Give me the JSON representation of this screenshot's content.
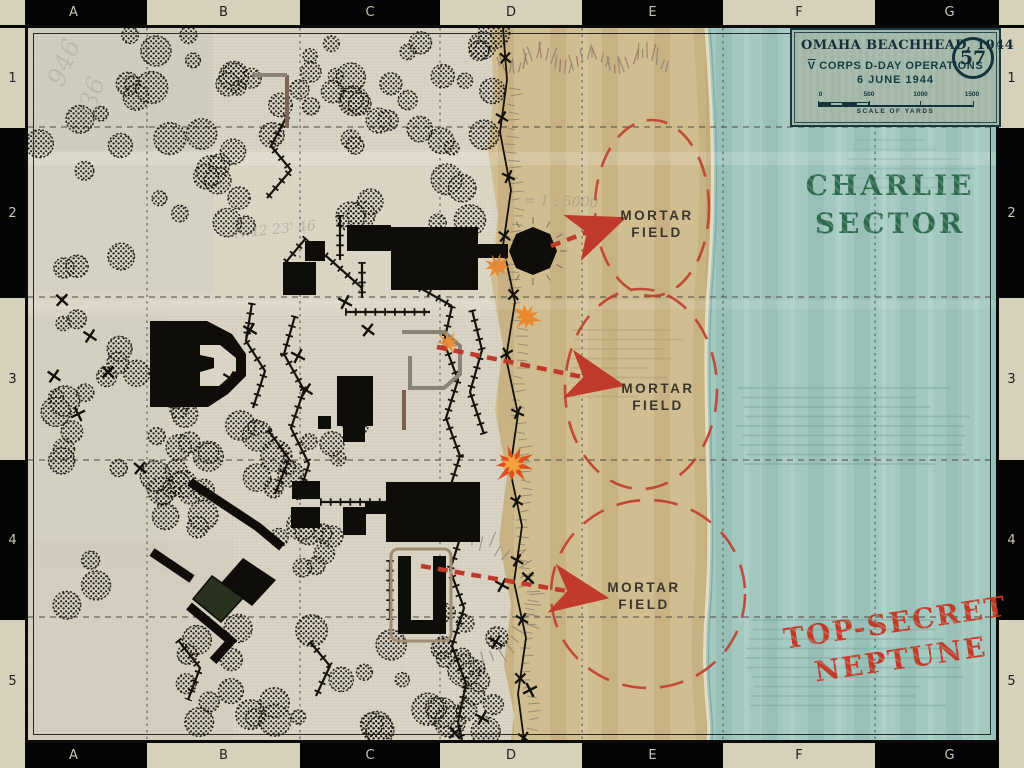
{
  "rulers": {
    "columns": [
      "A",
      "B",
      "C",
      "D",
      "E",
      "F",
      "G"
    ],
    "rows": [
      "1",
      "2",
      "3",
      "4",
      "5"
    ]
  },
  "title_box": {
    "title": "OMAHA BEACHHEAD, 1944",
    "map_number": "57",
    "corps_prefix": "V",
    "subtitle_rest": " CORPS D-DAY OPERATIONS",
    "date_line": "6 JUNE 1944",
    "scale_ticks": [
      "0",
      "500",
      "1000",
      "1500"
    ],
    "scale_caption": "SCALE OF YARDS"
  },
  "stamps": {
    "sector": {
      "line1": "CHARLIE",
      "line2": "SECTOR",
      "color": "#2d6a4c"
    },
    "classification": {
      "line1": "TOP-SECRET",
      "line2": "NEPTUNE",
      "color": "#c43a28"
    }
  },
  "mortar_fields": [
    {
      "line1": "MORTAR",
      "line2": "FIELD"
    },
    {
      "line1": "MORTAR",
      "line2": "FIELD"
    },
    {
      "line1": "MORTAR",
      "line2": "FIELD"
    }
  ],
  "pencil_notes": [
    "946",
    "936",
    "N.42 23' 46",
    "= 1 : 5000"
  ],
  "colors": {
    "sea": "#a3c8c0",
    "beach": "#d0bd90",
    "paper": "#d9d4c4",
    "arrow_red": "#bf3a2b",
    "stamp_red": "#c43a28",
    "stamp_green": "#2d6a4c",
    "title_box_bg": "#a2b7a8",
    "ruler_cream": "#d6d1bb"
  }
}
